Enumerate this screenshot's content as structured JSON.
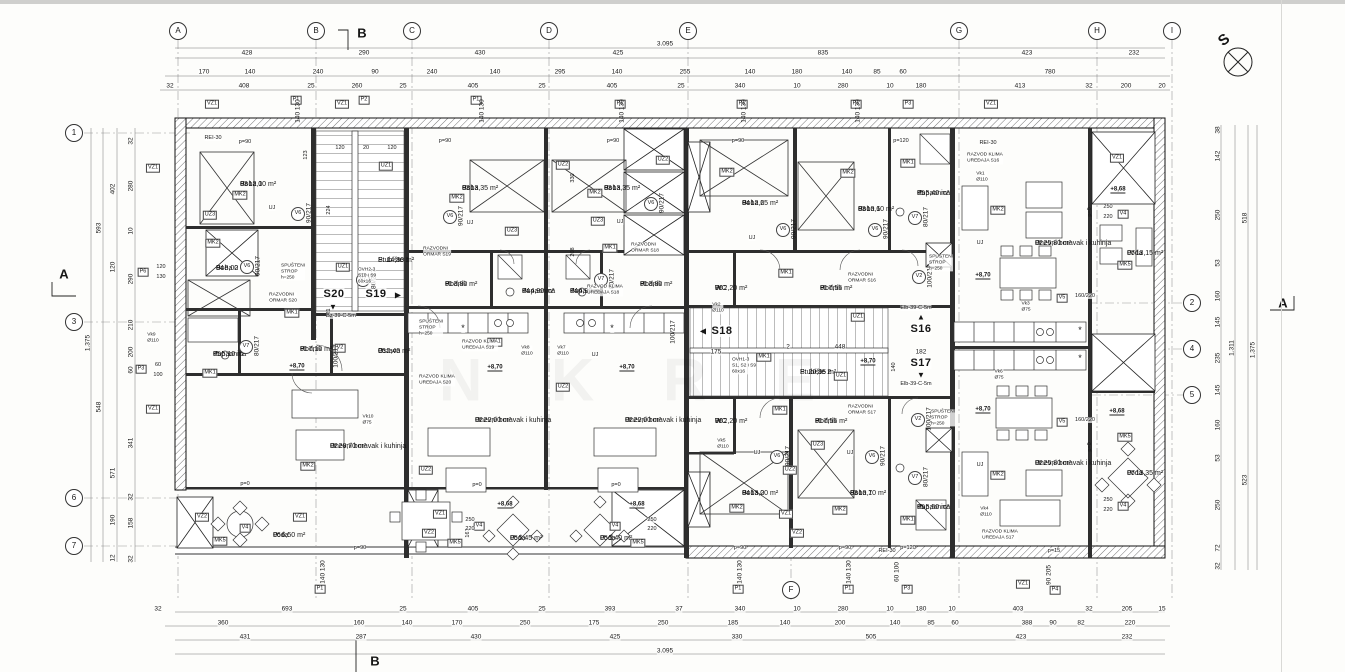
{
  "grid": {
    "cols": [
      "A",
      "B",
      "C",
      "D",
      "E",
      "F",
      "G",
      "H",
      "I"
    ],
    "rows_left": [
      "1",
      "3",
      "6",
      "7"
    ],
    "rows_right": [
      "2",
      "4",
      "5"
    ]
  },
  "marks": {
    "north": "S",
    "section_a": "A",
    "section_b": "B"
  },
  "apartments": {
    "s16": "S16",
    "s17": "S17",
    "s18": "S18",
    "s19": "S19",
    "s20": "S20",
    "tri_up": "▲",
    "tri_down": "▼",
    "tri_left": "◀",
    "tri_right": "▶"
  },
  "rooms": [
    {
      "num": "03",
      "name": "Soba 1",
      "area": "P: 12,00 m²"
    },
    {
      "num": "04",
      "name": "Soba 2",
      "area": "P: 8,00 m²"
    },
    {
      "num": "05",
      "name": "Kupaonica",
      "area": "P: 5,10 m²"
    },
    {
      "num": "01",
      "name": "Hodnik",
      "area": "P: 7,10 m²"
    },
    {
      "num": "02",
      "name": "Dnevni boravak i kuhinja",
      "area": "P: 28,70 m²"
    },
    {
      "num": "06",
      "name": "Loda",
      "area": "P: 6,50 m²"
    },
    {
      "num": "06",
      "name": "Ostava",
      "area": "P: 2,40 m²"
    },
    {
      "num": "",
      "name": "Stubište 1",
      "area": "P: 14,80 m²"
    },
    {
      "num": "03",
      "name": "Soba",
      "area": "P: 13,35 m²"
    },
    {
      "num": "04",
      "name": "Kupaonica",
      "area": "P: 4,90 m²"
    },
    {
      "num": "01",
      "name": "Hodnik",
      "area": "P: 3,80 m²"
    },
    {
      "num": "02",
      "name": "Dnevni boravak i kuhinja",
      "area": "P: 22,00 m²"
    },
    {
      "num": "05",
      "name": "Loda",
      "area": "P: 5,45 m²"
    },
    {
      "num": "03",
      "name": "Soba",
      "area": "P: 13,35 m²"
    },
    {
      "num": "04",
      "name": "Kupaonica",
      "area": "P: 4,90 m²"
    },
    {
      "num": "01",
      "name": "Hodnik",
      "area": "P: 3,80 m²"
    },
    {
      "num": "02",
      "name": "Dnevni boravak i kuhinja",
      "area": "P: 22,00 m²"
    },
    {
      "num": "05",
      "name": "Loda",
      "area": "P: 5,40 m²"
    },
    {
      "num": "04",
      "name": "Soba 2",
      "area": "P: 12,65 m²"
    },
    {
      "num": "03",
      "name": "Soba 1",
      "area": "P: 10,60 m²"
    },
    {
      "num": "05",
      "name": "Kupaonica",
      "area": "P: 5,40 m²"
    },
    {
      "num": "01",
      "name": "Hodnik",
      "area": "P: 7,55 m²"
    },
    {
      "num": "06",
      "name": "WC",
      "area": "P: 2,20 m²"
    },
    {
      "num": "02",
      "name": "Dnevni boravak i kuhinja",
      "area": "P: 25,80 m²"
    },
    {
      "num": "07",
      "name": "Loda",
      "area": "P: 13,15 m²"
    },
    {
      "num": "",
      "name": "Stubište 2",
      "area": "P: 20,95 m²"
    },
    {
      "num": "04",
      "name": "Soba 2",
      "area": "P: 13,00 m²"
    },
    {
      "num": "03",
      "name": "Soba 1",
      "area": "P: 10,70 m²"
    },
    {
      "num": "05",
      "name": "Kupaonica",
      "area": "P: 5,50 m²"
    },
    {
      "num": "01",
      "name": "Hodnik",
      "area": "P: 7,55 m²"
    },
    {
      "num": "06",
      "name": "WC",
      "area": "P: 2,20 m²"
    },
    {
      "num": "02",
      "name": "Dnevni boravak i kuhinja",
      "area": "P: 25,80 m²"
    },
    {
      "num": "07",
      "name": "Loda",
      "area": "P: 13,35 m²"
    }
  ],
  "codes": {
    "vz1": "VZ1",
    "vz2": "VZ2",
    "uz1": "UZ1",
    "uz2": "UZ2",
    "uz3": "UZ3",
    "mk1": "MK1",
    "mk2": "MK2",
    "mk5": "MK5",
    "p1": "P1",
    "p2": "P2",
    "p3": "P3",
    "p4": "P4",
    "p6": "P6",
    "v2": "V2",
    "v4": "V4",
    "v5": "V5",
    "v6": "V6",
    "v7": "V7",
    "d60": "60",
    "d100": "100",
    "d120": "120",
    "d130": "130",
    "d250": "250",
    "d220": "220"
  },
  "labels": {
    "door90": "90/217",
    "door80": "80/217",
    "door100": "100/217",
    "pair140": "140 130",
    "pair60100": "60 100",
    "pair90205": "90 205",
    "v5pair": "160/220",
    "vk1": "Vk1\nØ110",
    "vk2": "Vk2\nØ110",
    "vk3": "Vk3\nØ75",
    "vk4": "Vk4\nØ110",
    "vk5": "Vk5\nØ110",
    "vk6": "Vk6\nØ75",
    "vk7": "Vk7\nØ110",
    "vk8": "Vk8\nØ110",
    "vk9": "Vk9\nØ110",
    "vk10": "Vk10\nØ75",
    "e870": "+8,70",
    "e868": "+8,68",
    "p90": "p=90",
    "p120": "p=120",
    "p0": "p=0",
    "p15": "p=15",
    "rei30": "REI-30",
    "uj": "UJ",
    "elb": "Elb-39-C-5m",
    "bz": "Bz-39-C-5m",
    "ormar_s16": "RAZVODNI\nORMAR S16",
    "ormar_s17": "RAZVODNI\nORMAR S17",
    "ormar_s18": "RAZVODNI\nORMAR S18",
    "ormar_s19": "RAZVODNI\nORMAR S19",
    "ormar_s20": "RAZVODNI\nORMAR S20",
    "klima_s16": "RAZVOD KLIMA\nUREĐAJA S16",
    "klima_s17": "RAZVOD KLIMA\nUREĐAJA S17",
    "klima_s18": "RAZVOD KLIMA\nUREĐAJA S18",
    "klima_s19": "RAZVOD KLIMA\nUREĐAJA S19",
    "klima_s20": "RAZVOD KLIMA\nUREĐAJA S20",
    "spus": "SPUŠTENI\nSTROP\nh=250",
    "ovh2": "OVH2-3\nS10 i S9\n60x16",
    "ovh1": "OVH1-3\nS1, S2 i S9\n60x16",
    "watermark": "N K R E"
  },
  "dims": {
    "top_total": "3.095",
    "bottom_total": "3.095",
    "top_bays": [
      "428",
      "290",
      "430",
      "425",
      "835",
      "423",
      "232"
    ],
    "top_mid": [
      "170",
      "140",
      "240",
      "90",
      "240",
      "140",
      "295",
      "140",
      "255",
      "140",
      "180",
      "140",
      "85",
      "60",
      "780"
    ],
    "top_inner": [
      "32",
      "408",
      "25",
      "260",
      "25",
      "405",
      "25",
      "405",
      "25",
      "340",
      "10",
      "280",
      "10",
      "180",
      "413",
      "32",
      "200",
      "20"
    ],
    "bottom_r1": [
      "32",
      "693",
      "25",
      "405",
      "25",
      "393",
      "37",
      "340",
      "10",
      "280",
      "10",
      "180",
      "10",
      "403",
      "32",
      "205",
      "15"
    ],
    "bottom_r2": [
      "360",
      "160",
      "140",
      "170",
      "250",
      "175",
      "250",
      "185",
      "140",
      "200",
      "140",
      "85",
      "60",
      "388",
      "90",
      "82",
      "220"
    ],
    "bottom_r3": [
      "431",
      "287",
      "430",
      "425",
      "330",
      "505",
      "423",
      "232"
    ],
    "left_inner": [
      "32",
      "280",
      "10",
      "290",
      "210",
      "200",
      "60",
      "341",
      "32",
      "158",
      "32"
    ],
    "left_mid": [
      "402",
      "120",
      "571",
      "190",
      "12"
    ],
    "left_outer": [
      "593",
      "548"
    ],
    "left_total": "1.375",
    "right_inner": [
      "38",
      "142",
      "250",
      "53",
      "160",
      "145",
      "235",
      "145",
      "160",
      "53",
      "250",
      "72",
      "32"
    ],
    "right_mid": [
      "518",
      "523"
    ],
    "right_total_inner": "1.311",
    "right_total": "1.375",
    "stair2": [
      "175",
      "2",
      "448",
      "182"
    ],
    "stair2_v": "140",
    "interior_v": [
      "123",
      "224",
      "221",
      "330",
      "208",
      "163"
    ],
    "interior_h": [
      "120",
      "20",
      "120"
    ],
    "asterisk": "*"
  }
}
